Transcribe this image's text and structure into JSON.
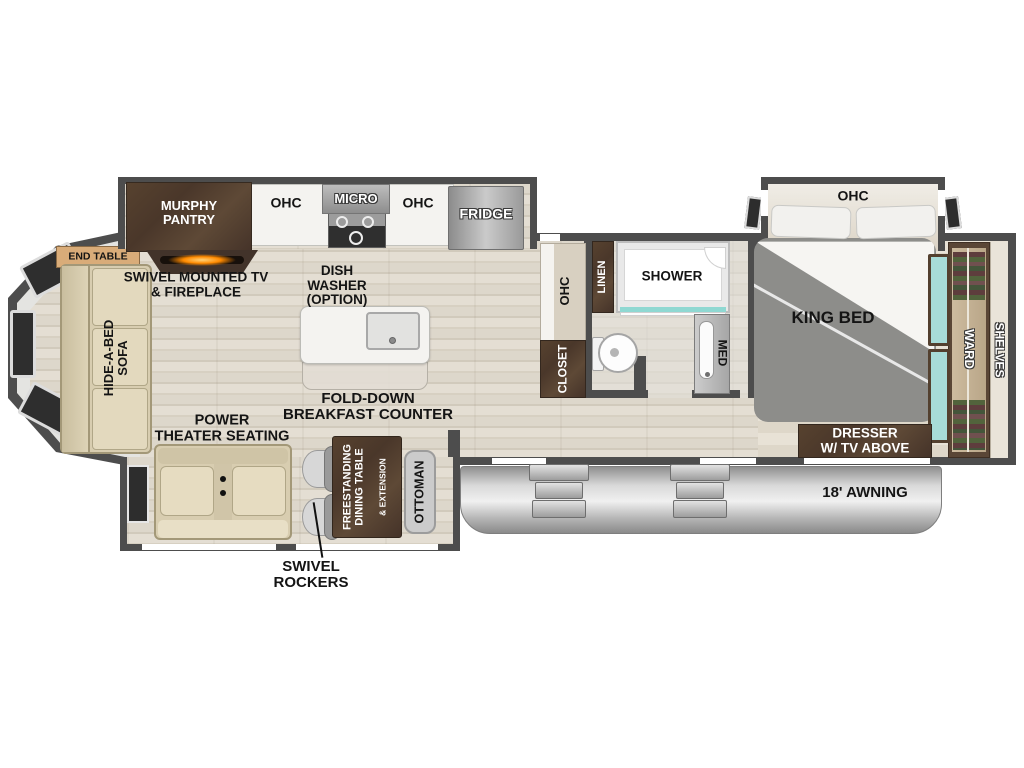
{
  "title": "Fifth-wheel RV floor plan",
  "colors": {
    "wall": "#4d4d4d",
    "floor_wood": "#ddd7cb",
    "dark_cabinet_wood": "#4e3a2c",
    "sofa_beige": "#d8cdb0",
    "ward_mirror_teal": "#a7dcd8",
    "awning_gray": "#c7c7c7",
    "fireplace_orange": "#ff8a00"
  },
  "kitchen": {
    "murphy_pantry": "MURPHY\nPANTRY",
    "ohc_left": "OHC",
    "micro": "MICRO",
    "ohc_right": "OHC",
    "fridge": "FRIDGE",
    "dish_washer": "DISH\nWASHER\n(OPTION)",
    "fold_down_counter": "FOLD-DOWN\nBREAKFAST COUNTER"
  },
  "living": {
    "end_table": "END TABLE",
    "hide_a_bed_sofa": "HIDE-A-BED\nSOFA",
    "swivel_tv_fireplace": "SWIVEL MOUNTED TV\n& FIREPLACE",
    "power_theater_seating": "POWER\nTHEATER SEATING",
    "swivel_rockers": "SWIVEL\nROCKERS",
    "dining_table": "FREESTANDING\nDINING TABLE",
    "dining_table_ext": "& EXTENSION",
    "ottoman": "OTTOMAN"
  },
  "bathroom": {
    "ohc": "OHC",
    "closet": "CLOSET",
    "linen": "LINEN",
    "shower": "SHOWER",
    "med": "MED"
  },
  "bedroom": {
    "ohc": "OHC",
    "king_bed": "KING BED",
    "ward": "WARD",
    "shelves": "SHELVES",
    "dresser": "DRESSER\nW/ TV ABOVE"
  },
  "exterior": {
    "awning": "18' AWNING"
  }
}
